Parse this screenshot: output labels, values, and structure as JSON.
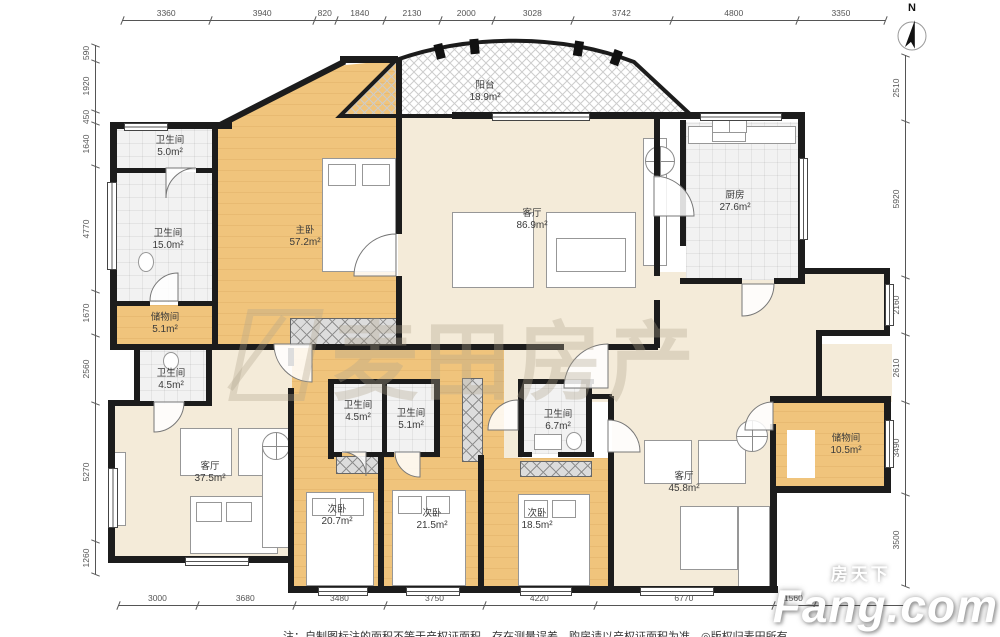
{
  "compass_label": "N",
  "watermark_text": "麦田房产",
  "brand": {
    "cn": "房天下",
    "en": "Fang.com"
  },
  "note": "注：自制图标注的面积不等于产权证面积，存在测量误差，购房请以产权证面积为准。◎版权归麦田所有",
  "colors": {
    "bedroom": "#f0c47c",
    "living": "#f4ebd9",
    "tile": "#f2f2f2",
    "wall": "#1c1c1c"
  },
  "rooms": {
    "bath_tl": {
      "name": "卫生间",
      "area": "5.0m²"
    },
    "bath_left": {
      "name": "卫生间",
      "area": "15.0m²"
    },
    "storage_left": {
      "name": "储物间",
      "area": "5.1m²"
    },
    "master": {
      "name": "主卧",
      "area": "57.2m²"
    },
    "balcony": {
      "name": "阳台",
      "area": "18.9m²"
    },
    "living_main": {
      "name": "客厅",
      "area": "86.9m²"
    },
    "kitchen": {
      "name": "厨房",
      "area": "27.6m²"
    },
    "bath_ll": {
      "name": "卫生间",
      "area": "4.5m²"
    },
    "living_ll": {
      "name": "客厅",
      "area": "37.5m²"
    },
    "bath_m1": {
      "name": "卫生间",
      "area": "4.5m²"
    },
    "bath_m2": {
      "name": "卫生间",
      "area": "5.1m²"
    },
    "bath_m3": {
      "name": "卫生间",
      "area": "6.7m²"
    },
    "bed1": {
      "name": "次卧",
      "area": "20.7m²"
    },
    "bed2": {
      "name": "次卧",
      "area": "21.5m²"
    },
    "bed3": {
      "name": "次卧",
      "area": "18.5m²"
    },
    "living_r": {
      "name": "客厅",
      "area": "45.8m²"
    },
    "storage_r": {
      "name": "储物间",
      "area": "10.5m²"
    }
  },
  "dimensions": {
    "top": [
      "3360",
      "3940",
      "820",
      "1840",
      "2130",
      "2000",
      "3028",
      "3742",
      "4800",
      "3350"
    ],
    "bottom": [
      "3000",
      "3680",
      "3480",
      "3750",
      "4220",
      "6770",
      "1560"
    ],
    "left": [
      "590",
      "1920",
      "450",
      "1640",
      "4770",
      "1670",
      "2560",
      "5270",
      "1260"
    ],
    "right": [
      "2510",
      "5920",
      "2160",
      "2610",
      "3490",
      "3500"
    ]
  }
}
